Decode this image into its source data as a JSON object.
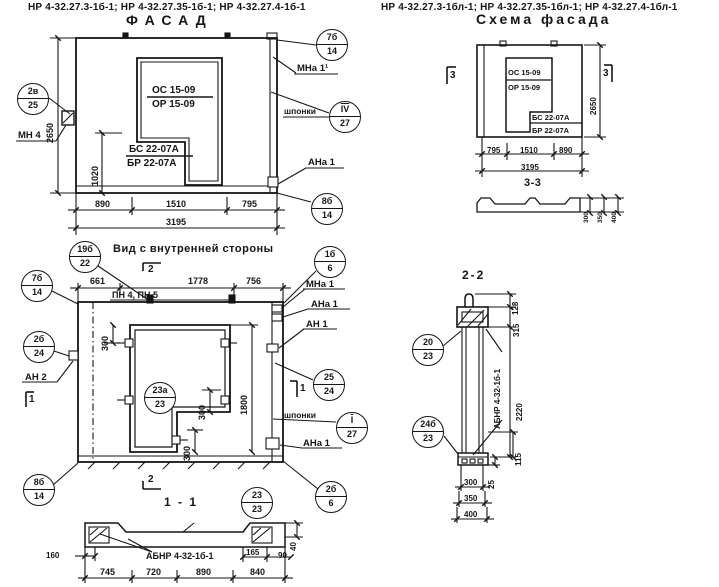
{
  "colors": {
    "ink": "#151515",
    "paper": "#ffffff"
  },
  "header": {
    "left": "НР 4-32.27.3-1б-1; НР 4-32.27.35-1б-1; НР 4-32.27.4-1б-1",
    "right": "НР 4-32.27.3-1бл-1; НР 4-32.27.35-1бл-1; НР 4-32.27.4-1бл-1"
  },
  "facade": {
    "title": "ФАСАД",
    "mark_os": "ОС 15-09",
    "mark_or": "ОР 15-09",
    "mark_bs": "БС 22-07А",
    "mark_br": "БР 22-07А",
    "dim_height": "2650",
    "dim_1020": "1020",
    "dims_bottom": [
      "890",
      "1510",
      "795"
    ],
    "dim_total": "3195",
    "label_mn4": "МН 4",
    "label_mna1": "МНа 1¹",
    "label_shponki": "шпонки",
    "label_ana1": "АНа 1",
    "co_2v": {
      "t": "2в",
      "b": "25"
    },
    "co_7b": {
      "t": "7б",
      "b": "14"
    },
    "co_iv": {
      "t": "IV",
      "b": "27"
    },
    "co_8b": {
      "t": "8б",
      "b": "14"
    }
  },
  "inner": {
    "title": "Вид с внутренней стороны",
    "dims_top": [
      "661",
      "1778",
      "756"
    ],
    "label_pn": "ПН 4, ПН 5",
    "dim_300": "300",
    "dim_1800": "1800",
    "label_mna1": "МНа 1",
    "label_ana1": "АНа 1",
    "label_an1": "АН 1",
    "label_an2": "АН 2",
    "label_shponki": "шпонки",
    "label_ana1b": "АНа 1",
    "marker_1": "1",
    "marker_2": "2",
    "co_19b": {
      "t": "19б",
      "b": "22"
    },
    "co_1b": {
      "t": "1б",
      "b": "6"
    },
    "co_7b": {
      "t": "7б",
      "b": "14"
    },
    "co_2b24": {
      "t": "2б",
      "b": "24"
    },
    "co_8b": {
      "t": "8б",
      "b": "14"
    },
    "co_23a": {
      "t": "23а",
      "b": "23"
    },
    "co_25": {
      "t": "25",
      "b": "24"
    },
    "co_i": {
      "t": "I",
      "b": "27"
    },
    "co_2b6": {
      "t": "2б",
      "b": "6"
    }
  },
  "section11": {
    "title": "1 - 1",
    "co_23": {
      "t": "23",
      "b": "23"
    },
    "label_ab": "АБНР 4-32-1б-1",
    "dim_160": "160",
    "dim_165": "165",
    "dim_90": "90",
    "dim_40": "40",
    "dims_bottom": [
      "745",
      "720",
      "890",
      "840"
    ]
  },
  "schema": {
    "title": "Схема фасада",
    "marker_3": "3",
    "mark_os": "ОС 15-09",
    "mark_or": "ОР 15-09",
    "mark_bs": "БС 22-07А",
    "mark_br": "БР 22-07А",
    "dim_height": "2650",
    "dims_bottom": [
      "795",
      "1510",
      "890"
    ],
    "dim_total": "3195",
    "section_title": "3-3",
    "dims_layers": [
      "300",
      "350",
      "400"
    ]
  },
  "section22": {
    "title": "2-2",
    "dim_128": "128",
    "dim_315": "315",
    "dim_2220": "2220",
    "dim_115": "115",
    "dim_25": "25",
    "dims_bottom": [
      "300",
      "350",
      "400"
    ],
    "label_ab": "АБНР 4-32-1б-1",
    "co_20": {
      "t": "20",
      "b": "23"
    },
    "co_24b": {
      "t": "24б",
      "b": "23"
    }
  }
}
